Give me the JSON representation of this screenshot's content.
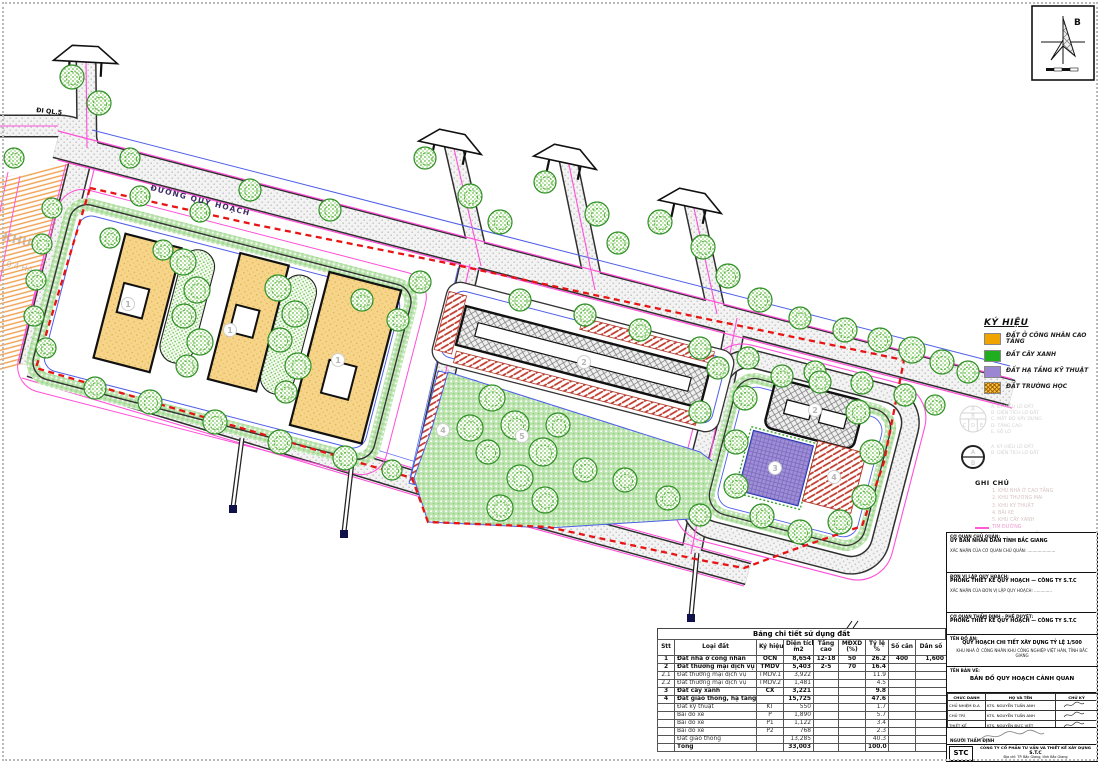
{
  "sheet": {
    "north_label": "B"
  },
  "map": {
    "road_label": "ĐƯỜNG QUY HOẠCH",
    "exit_label": "ĐI QL.5",
    "adjacent_label": "KHU DÂN CƯ",
    "adjacent_area": "0.4 HA",
    "plot_badges": [
      "1",
      "1",
      "1",
      "2",
      "2",
      "3",
      "4",
      "4",
      "5"
    ]
  },
  "legend": {
    "title": "KÝ HIỆU",
    "items": [
      {
        "label": "ĐẤT Ở CÔNG NHÂN CAO TẦNG",
        "color": "#f0a400",
        "hatch": false
      },
      {
        "label": "ĐẤT CÂY XANH",
        "color": "#1fae1f",
        "hatch": false
      },
      {
        "label": "ĐẤT HẠ TẦNG KỸ THUẬT",
        "color": "#9a86d2",
        "hatch": false
      },
      {
        "label": "ĐẤT TRƯỜNG HỌC",
        "color": "#ffc43c",
        "hatch": true
      }
    ]
  },
  "notes": {
    "circle5_labels": [
      "A. KÝ HIỆU LÔ ĐẤT",
      "B. DIỆN TÍCH LÔ ĐẤT",
      "C. MẬT ĐỘ XÂY DỰNG",
      "D. TẦNG CAO",
      "E. SỐ LÔ"
    ],
    "circle2_labels": [
      "A. KÝ HIỆU LÔ ĐẤT",
      "B. DIỆN TÍCH LÔ ĐẤT"
    ],
    "ghichu_title": "GHI CHÚ",
    "ghichu_items": [
      {
        "text": "1. KHU NHÀ Ở CAO TẦNG",
        "style": "gray"
      },
      {
        "text": "2. KHU THƯƠNG MẠI",
        "style": "gray"
      },
      {
        "text": "3. KHU KỸ THUẬT",
        "style": "gray"
      },
      {
        "text": "4. BÃI XE",
        "style": "gray"
      },
      {
        "text": "5. KHU CÂY XANH",
        "style": "gray"
      },
      {
        "text": "TIM ĐƯỜNG",
        "style": "pink"
      },
      {
        "text": "RANH GIỚI KHU ĐẤT",
        "style": "boundary"
      }
    ]
  },
  "table": {
    "title": "Bảng chi tiết sử dụng đất",
    "headers": [
      {
        "l1": "Stt",
        "l2": ""
      },
      {
        "l1": "Loại đất",
        "l2": ""
      },
      {
        "l1": "Ký hiệu",
        "l2": ""
      },
      {
        "l1": "Diện tích",
        "l2": "m2"
      },
      {
        "l1": "Tầng",
        "l2": "cao"
      },
      {
        "l1": "MĐXD",
        "l2": "(%)"
      },
      {
        "l1": "Tỷ lệ",
        "l2": "%"
      },
      {
        "l1": "Số căn",
        "l2": ""
      },
      {
        "l1": "Dân số",
        "l2": ""
      }
    ],
    "rows": [
      {
        "c": [
          "1",
          "Đất nhà ở công nhân",
          "OCN",
          "8,654",
          "12-18",
          "50",
          "26.2",
          "400",
          "1,600"
        ],
        "bold": true
      },
      {
        "c": [
          "2",
          "Đất thương mại dịch vụ",
          "TMDV",
          "5,403",
          "2-5",
          "70",
          "16.4",
          "",
          ""
        ],
        "bold": true
      },
      {
        "c": [
          "2.1",
          "Đất thương mại dịch vụ",
          "TMDV.1",
          "3,922",
          "",
          "",
          "11.9",
          "",
          ""
        ],
        "bold": false
      },
      {
        "c": [
          "2.2",
          "Đất thương mại dịch vụ",
          "TMDV.2",
          "1,481",
          "",
          "",
          "4.5",
          "",
          ""
        ],
        "bold": false
      },
      {
        "c": [
          "3",
          "Đất cây xanh",
          "CX",
          "3,221",
          "",
          "",
          "9.8",
          "",
          ""
        ],
        "bold": true
      },
      {
        "c": [
          "4",
          "Đất giao thông, hạ tầng kỹ thuật",
          "",
          "15,725",
          "",
          "",
          "47.6",
          "",
          ""
        ],
        "bold": true
      },
      {
        "c": [
          "",
          "Đất kỹ thuật",
          "KT",
          "550",
          "",
          "",
          "1.7",
          "",
          ""
        ],
        "bold": false
      },
      {
        "c": [
          "",
          "Bãi đỗ xe",
          "P",
          "1,890",
          "",
          "",
          "5.7",
          "",
          ""
        ],
        "bold": false
      },
      {
        "c": [
          "",
          "Bãi đỗ xe",
          "P1",
          "1,122",
          "",
          "",
          "3.4",
          "",
          ""
        ],
        "bold": false
      },
      {
        "c": [
          "",
          "Bãi đỗ xe",
          "P2",
          "768",
          "",
          "",
          "2.3",
          "",
          ""
        ],
        "bold": false
      },
      {
        "c": [
          "",
          "Đất giao thông",
          "",
          "13,285",
          "",
          "",
          "40.3",
          "",
          ""
        ],
        "bold": false
      },
      {
        "c": [
          "",
          "Tổng",
          "",
          "33,003",
          "",
          "",
          "100.0",
          "",
          ""
        ],
        "bold": true
      }
    ]
  },
  "titleblock": {
    "s1_label": "CƠ QUAN CHỦ QUẢN:",
    "s1_name": "ỦY BAN NHÂN DÂN TỈNH BẮC GIANG",
    "s1_sign": "XÁC NHẬN CỦA CƠ QUAN CHỦ QUẢN: ......................",
    "s2_label": "ĐƠN VỊ LẬP QUY HOẠCH:",
    "s2_name": "PHÒNG THIẾT KẾ QUY HOẠCH — CÔNG TY S.T.C",
    "s2_sign": "XÁC NHẬN CỦA ĐƠN VỊ LẬP QUY HOẠCH: ..............",
    "s3_label": "CƠ QUAN THẨM ĐỊNH - PHÊ DUYỆT:",
    "s3_name": "PHÒNG THIẾT KẾ QUY HOẠCH — CÔNG TY S.T.C",
    "s4_label": "TÊN ĐỒ ÁN:",
    "s4_name1": "QUY HOẠCH CHI TIẾT XÂY DỰNG TỶ LỆ 1/500",
    "s4_name2": "KHU NHÀ Ở CÔNG NHÂN KHU CÔNG NGHIỆP VIỆT HÀN, TỈNH BẮC GIANG",
    "s5_label": "TÊN BẢN VẼ:",
    "s5_name": "BẢN ĐỒ QUY HOẠCH CẢNH QUAN",
    "sig_headers": [
      "CHỨC DANH",
      "HỌ VÀ TÊN",
      "CHỮ KÝ"
    ],
    "sig_rows": [
      [
        "CHỦ NHIỆM Đ.A",
        "KTS. NGUYỄN TUẤN ANH"
      ],
      [
        "CHỦ TRÌ",
        "KTS. NGUYỄN TUẤN ANH"
      ],
      [
        "THIẾT KẾ",
        "KTS. NGUYỄN ĐỨC VIỆT"
      ],
      [
        "QL. KỸ THUẬT",
        "KTS. NGUYỄN VĂN CHIẾN"
      ]
    ],
    "review_label": "NGƯỜI THẨM ĐỊNH",
    "logo": "STC",
    "company_line1": "CÔNG TY CỔ PHẦN TƯ VẤN VÀ THIẾT KẾ XÂY DỰNG",
    "company_line2": "S.T.C",
    "company_line3": "Địa chỉ: TP. Bắc Giang, tỉnh Bắc Giang"
  }
}
